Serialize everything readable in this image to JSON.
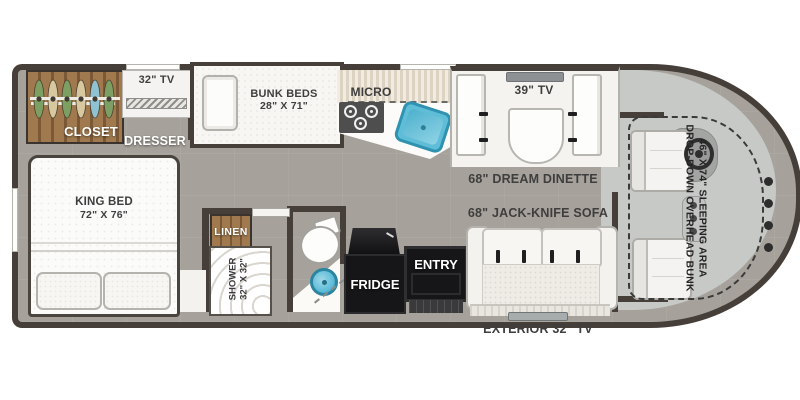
{
  "rooms": {
    "bedroom": {
      "closet_label": "CLOSET",
      "tv_label": "32\" TV",
      "dresser_label": "DRESSER",
      "bed_name": "KING BED",
      "bed_size": "72\" X 76\""
    },
    "bunk_room": {
      "name": "BUNK BEDS",
      "size": "28\" X 71\""
    },
    "kitchen": {
      "micro_label": "MICRO",
      "fridge_label": "FRIDGE"
    },
    "bathroom": {
      "linen_label": "LINEN",
      "shower_name": "SHOWER",
      "shower_size": "32\" X 32\""
    },
    "living": {
      "tv_label": "39\" TV",
      "dinette_label": "68\" DREAM DINETTE",
      "sofa_label": "68\" JACK-KNIFE SOFA",
      "entry_label": "ENTRY"
    },
    "exterior": {
      "tv_label": "EXTERIOR 32\" TV"
    },
    "cab": {
      "overhead_bunk_line1": "DROP-DOWN OVERHEAD BUNK",
      "overhead_bunk_line2": "46\" X 74\" SLEEPING AREA"
    }
  },
  "colors": {
    "wall": "#453e39",
    "floor": "#a6a29b",
    "cab_floor": "#c7c9c7",
    "wood_light": "#a07a4e",
    "wood_dark": "#7b5836",
    "counter_stripe_light": "#f1ebe1",
    "counter_stripe_dark": "#dcd3c3",
    "sink_blue": "#5fbdd8",
    "sink_blue_deep": "#2e92b0",
    "appliance_black": "#161618",
    "label_ink": "#3e3e3e"
  }
}
